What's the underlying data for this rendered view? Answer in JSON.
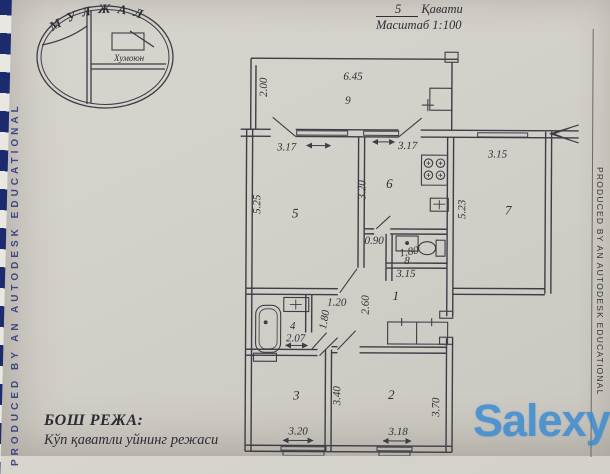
{
  "locator": {
    "title": "МУЛЖАЛ",
    "street": "Хумоюн"
  },
  "title_block": {
    "floor": "5",
    "floor_word": "Қавати",
    "scale": "Масштаб 1:100"
  },
  "edges": {
    "right_stamp": "PRODUCED BY AN AUTODESK EDUCATIONAL",
    "left_stamp": "PRODUCED BY AN AUTODESK EDUCATIONAL PRODUCT"
  },
  "footer": {
    "title": "БОШ РЕЖА:",
    "subtitle": "Кўп қаватли уйнинг режаси"
  },
  "watermark": {
    "text": "Salexy",
    "color": "#3d8bd0"
  },
  "plan": {
    "rooms": {
      "hall": "1",
      "room2": "2",
      "room3": "3",
      "bath": "4",
      "room5": "5",
      "kitchen": "6",
      "room7": "7",
      "toilet": "8",
      "balcony": "9"
    },
    "dims": {
      "balcony_depth": "2.00",
      "balcony_width": "6.45",
      "room5_width": "3.17",
      "room5_height": "5.25",
      "kitchen_width": "3.17",
      "kitchen_height": "3.20",
      "room7_width": "3.15",
      "room7_height": "5.23",
      "passage": "0.90",
      "toilet_width": "1.80",
      "hall_top_width": "3.15",
      "hall_height": "2.60",
      "nook_width": "1.20",
      "nook_height": "1.80",
      "bath_width": "2.07",
      "room3_width": "3.20",
      "room3_height": "3.40",
      "room2_width": "3.18",
      "room2_height": "3.70"
    }
  }
}
